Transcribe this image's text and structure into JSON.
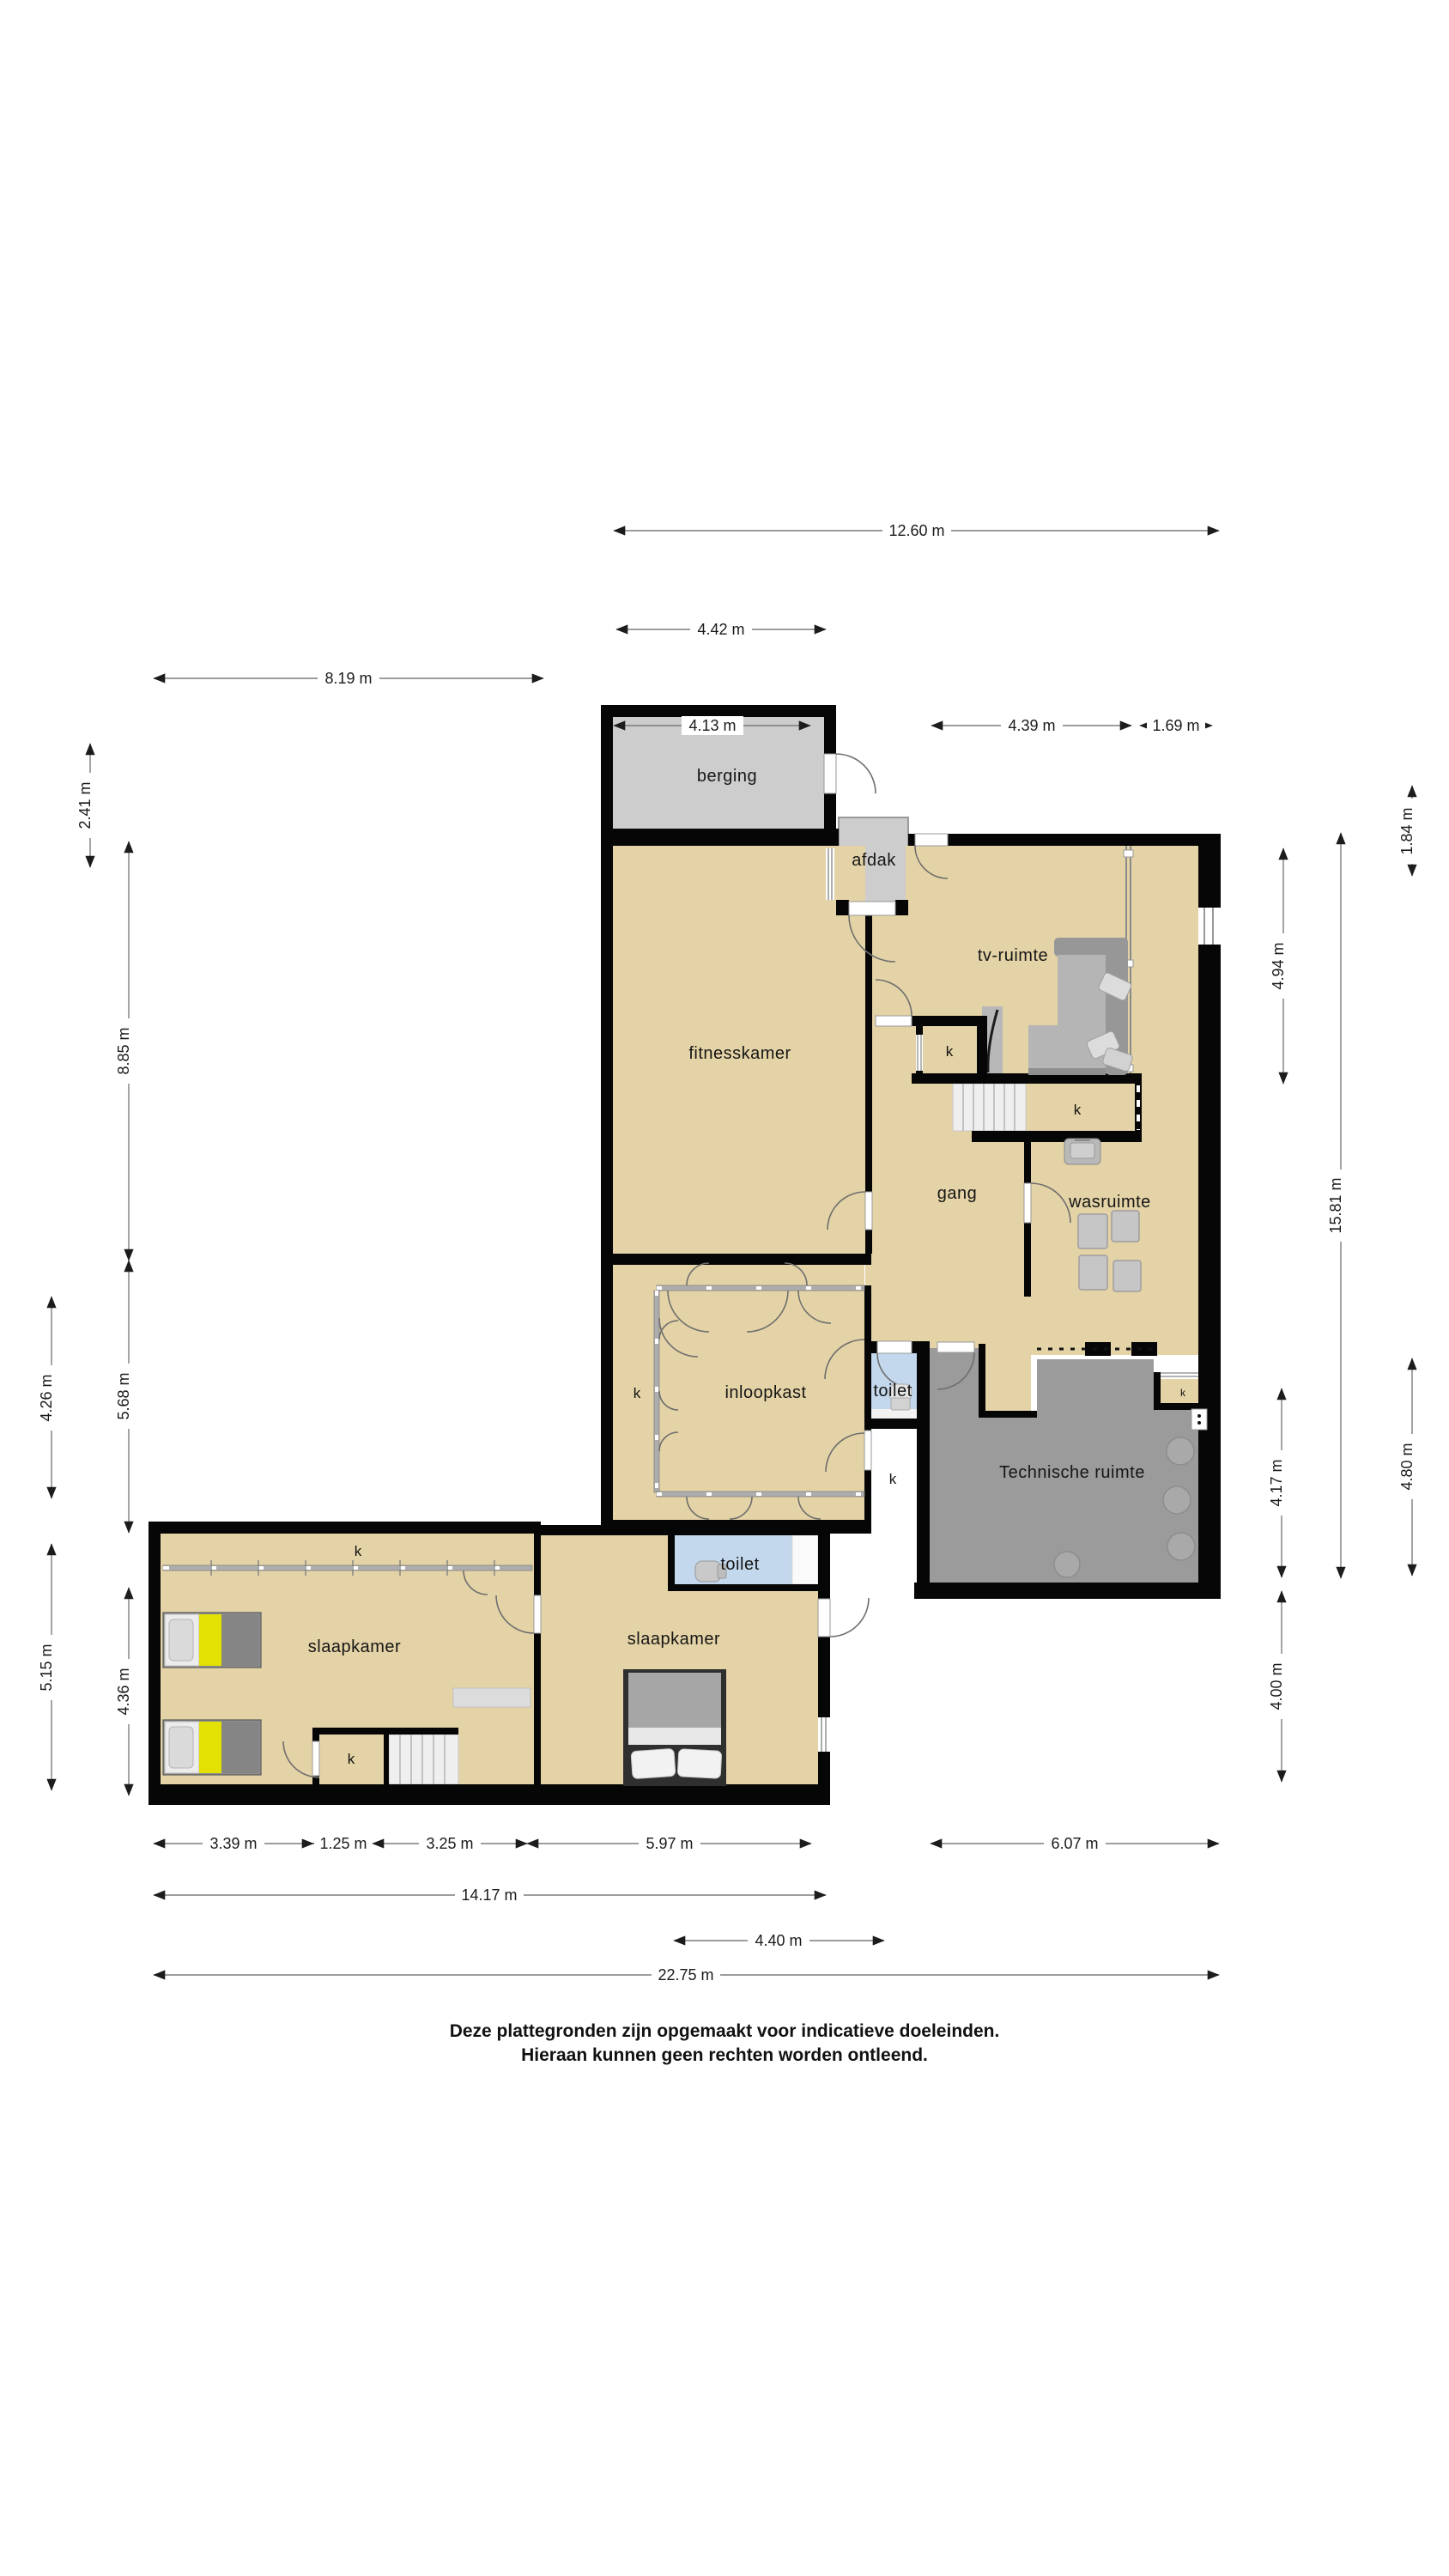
{
  "floorplan": {
    "rooms": {
      "berging": {
        "label": "berging"
      },
      "afdak": {
        "label": "afdak"
      },
      "fitnesskamer": {
        "label": "fitnesskamer"
      },
      "tv_ruimte": {
        "label": "tv-ruimte"
      },
      "gang": {
        "label": "gang"
      },
      "wasruimte": {
        "label": "wasruimte"
      },
      "inloopkast": {
        "label": "inloopkast"
      },
      "toilet_boven": {
        "label": "toilet"
      },
      "toilet_onder": {
        "label": "toilet"
      },
      "technische_ruimte": {
        "label": "Technische ruimte"
      },
      "slaapkamer_links": {
        "label": "slaapkamer"
      },
      "slaapkamer_rechts": {
        "label": "slaapkamer"
      }
    },
    "closet": {
      "label": "k"
    },
    "dimensions": {
      "top": [
        {
          "label": "12.60 m"
        },
        {
          "label": "4.42 m"
        },
        {
          "label": "8.19 m"
        },
        {
          "label": "4.13 m"
        },
        {
          "label": "4.39 m"
        },
        {
          "label": "1.69 m"
        }
      ],
      "left": [
        {
          "label": "2.41 m"
        },
        {
          "label": "8.85 m"
        },
        {
          "label": "5.68 m"
        },
        {
          "label": "4.26 m"
        },
        {
          "label": "5.15 m"
        },
        {
          "label": "4.36 m"
        }
      ],
      "right": [
        {
          "label": "1.84 m"
        },
        {
          "label": "4.94 m"
        },
        {
          "label": "15.81 m"
        },
        {
          "label": "4.17 m"
        },
        {
          "label": "4.80 m"
        },
        {
          "label": "4.00 m"
        }
      ],
      "bottom": [
        {
          "label": "3.39 m"
        },
        {
          "label": "1.25 m"
        },
        {
          "label": "3.25 m"
        },
        {
          "label": "5.97 m"
        },
        {
          "label": "6.07 m"
        },
        {
          "label": "14.17 m"
        },
        {
          "label": "4.40 m"
        },
        {
          "label": "22.75 m"
        }
      ]
    },
    "disclaimer": {
      "line1": "Deze plattegronden zijn opgemaakt voor indicatieve doeleinden.",
      "line2": "Hieraan kunnen geen rechten worden ontleend."
    },
    "colors": {
      "floor_beige": "#e4d3a6",
      "floor_grey": "#cdcdcd",
      "tech_grey": "#9b9b9b",
      "toilet_blue": "#c3d8ec",
      "wall_black": "#060606",
      "bed_accent_yellow": "#e3e003"
    }
  }
}
